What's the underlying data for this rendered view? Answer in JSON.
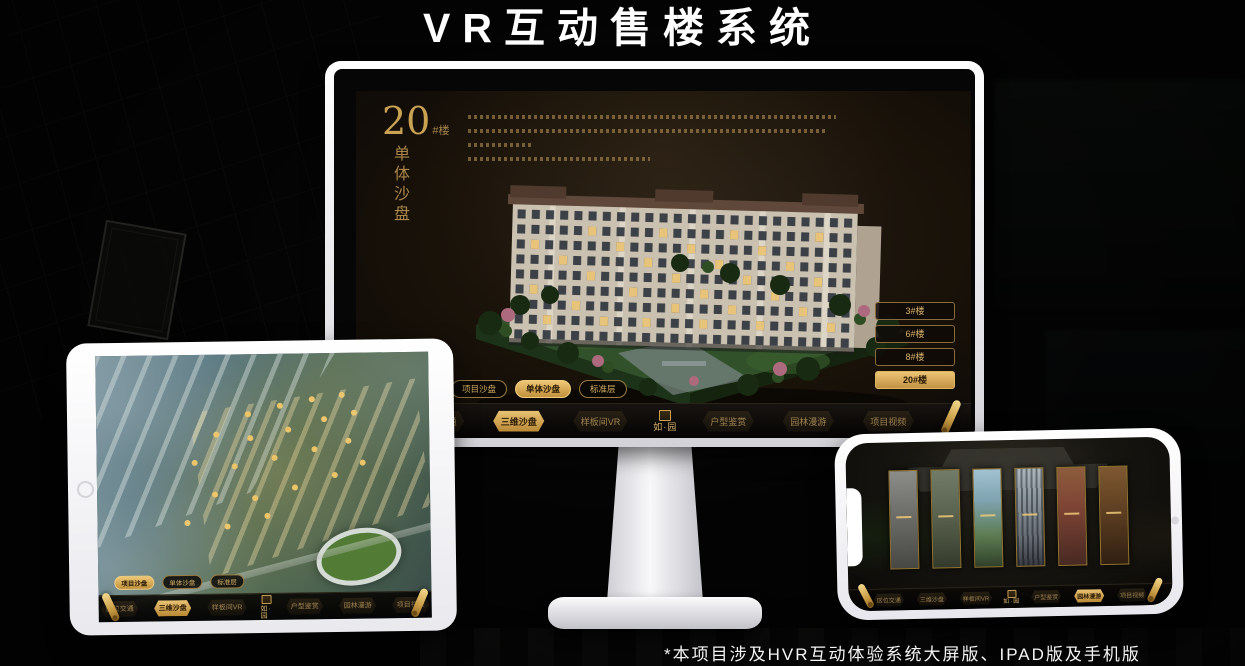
{
  "page": {
    "title": "VR互动售楼系统",
    "footnote": "*本项目涉及HVR互动体验系统大屏版、IPAD版及手机版"
  },
  "brand": {
    "logo_text": "如·园",
    "accent_gold": "#d8ae5f",
    "active_gold": "#e8c273"
  },
  "monitor_app": {
    "heading": {
      "number": "20",
      "suffix": "#楼",
      "subtitle_vertical": "单体沙盘"
    },
    "building_buttons": [
      {
        "label": "3#楼",
        "active": false
      },
      {
        "label": "6#楼",
        "active": false
      },
      {
        "label": "8#楼",
        "active": false
      },
      {
        "label": "20#楼",
        "active": true
      }
    ],
    "floor_tabs": [
      {
        "label": "项目沙盘",
        "active": false
      },
      {
        "label": "单体沙盘",
        "active": true
      },
      {
        "label": "标准层",
        "active": false
      }
    ],
    "menu_left": [
      {
        "label": "区位交通",
        "active": false
      },
      {
        "label": "三维沙盘",
        "active": true
      },
      {
        "label": "样板间VR",
        "active": false
      }
    ],
    "menu_right": [
      {
        "label": "户型鉴赏",
        "active": false
      },
      {
        "label": "园林漫游",
        "active": false
      },
      {
        "label": "项目视频",
        "active": false
      }
    ]
  },
  "tablet_app": {
    "floor_tabs": [
      {
        "label": "项目沙盘",
        "active": true
      },
      {
        "label": "单体沙盘",
        "active": false
      },
      {
        "label": "标准层",
        "active": false
      }
    ],
    "menu_left": [
      {
        "label": "区位交通",
        "active": false
      },
      {
        "label": "三维沙盘",
        "active": true
      },
      {
        "label": "样板间VR",
        "active": false
      }
    ],
    "menu_right": [
      {
        "label": "户型鉴赏",
        "active": false
      },
      {
        "label": "园林漫游",
        "active": false
      },
      {
        "label": "项目视频",
        "active": false
      }
    ]
  },
  "phone_app": {
    "menu_left": [
      {
        "label": "区位交通",
        "active": false
      },
      {
        "label": "三维沙盘",
        "active": false
      },
      {
        "label": "样板间VR",
        "active": false
      }
    ],
    "menu_right": [
      {
        "label": "户型鉴赏",
        "active": false
      },
      {
        "label": "园林漫游",
        "active": true
      },
      {
        "label": "项目视频",
        "active": false
      }
    ]
  }
}
